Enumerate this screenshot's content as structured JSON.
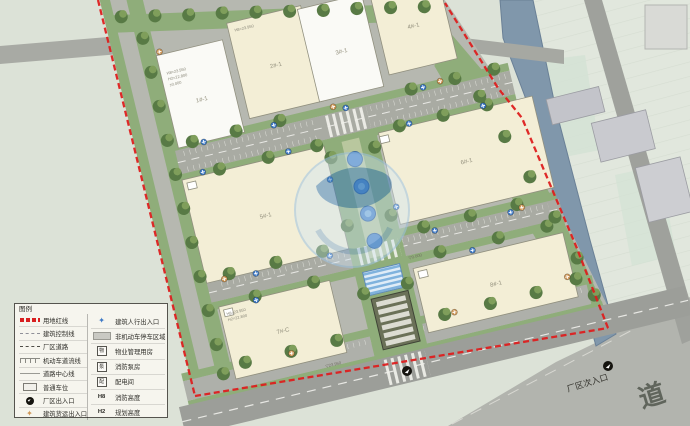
{
  "legend": {
    "title": "图例",
    "left": [
      {
        "symbol": "red-boundary-line",
        "label": "用地红线"
      },
      {
        "symbol": "dashed-line",
        "label": "建筑控制线"
      },
      {
        "symbol": "dash-dot-line",
        "label": "厂区道路"
      },
      {
        "symbol": "lane-tick-line",
        "label": "机动车道流线"
      },
      {
        "symbol": "center-line",
        "label": "道路中心线"
      },
      {
        "symbol": "parking-stall",
        "label": "普通车位"
      },
      {
        "symbol": "gate-icon",
        "label": "厂区出入口"
      },
      {
        "symbol": "orange-flower-icon",
        "label": "建筑货运出入口"
      }
    ],
    "right": [
      {
        "symbol": "blue-flower-icon",
        "box": "",
        "label": "建筑人行出入口"
      },
      {
        "symbol": "gray-area",
        "box": "",
        "label": "非机动车停车区域"
      },
      {
        "symbol": "boxed-char",
        "box": "物",
        "label": "物业管理用房"
      },
      {
        "symbol": "boxed-char",
        "box": "泵",
        "label": "消防泵房"
      },
      {
        "symbol": "boxed-char",
        "box": "配",
        "label": "配电间"
      },
      {
        "symbol": "h-token",
        "box": "H8",
        "label": "消防高度"
      },
      {
        "symbol": "h-token",
        "box": "H2",
        "label": "规划高度"
      }
    ]
  },
  "plan": {
    "buildings": [
      {
        "label": "1#-1"
      },
      {
        "label": "2#-1"
      },
      {
        "label": "3#-1"
      },
      {
        "label": "4#-1"
      },
      {
        "label": "5#-1"
      },
      {
        "label": "6#-1"
      },
      {
        "label": "7#-C"
      },
      {
        "label": "8#-1"
      }
    ],
    "annotation_block": [
      "H8=23.950",
      "H2=22.800",
      "±0.000"
    ],
    "level_marks": [
      "▽23.950",
      "▽0.000"
    ],
    "secondary_entrance_label": "厂区次入口",
    "road_name_char": "道"
  },
  "colors": {
    "boundary_red": "#DD1F1F",
    "pedestrian_entrance_blue": "#3D79C6",
    "freight_entrance_orange": "#CF9757",
    "river_blue": "#8097AB",
    "building_cream": "#F3EED6",
    "building_white": "#FAFAF6",
    "greenery": "#8FAD7A"
  }
}
